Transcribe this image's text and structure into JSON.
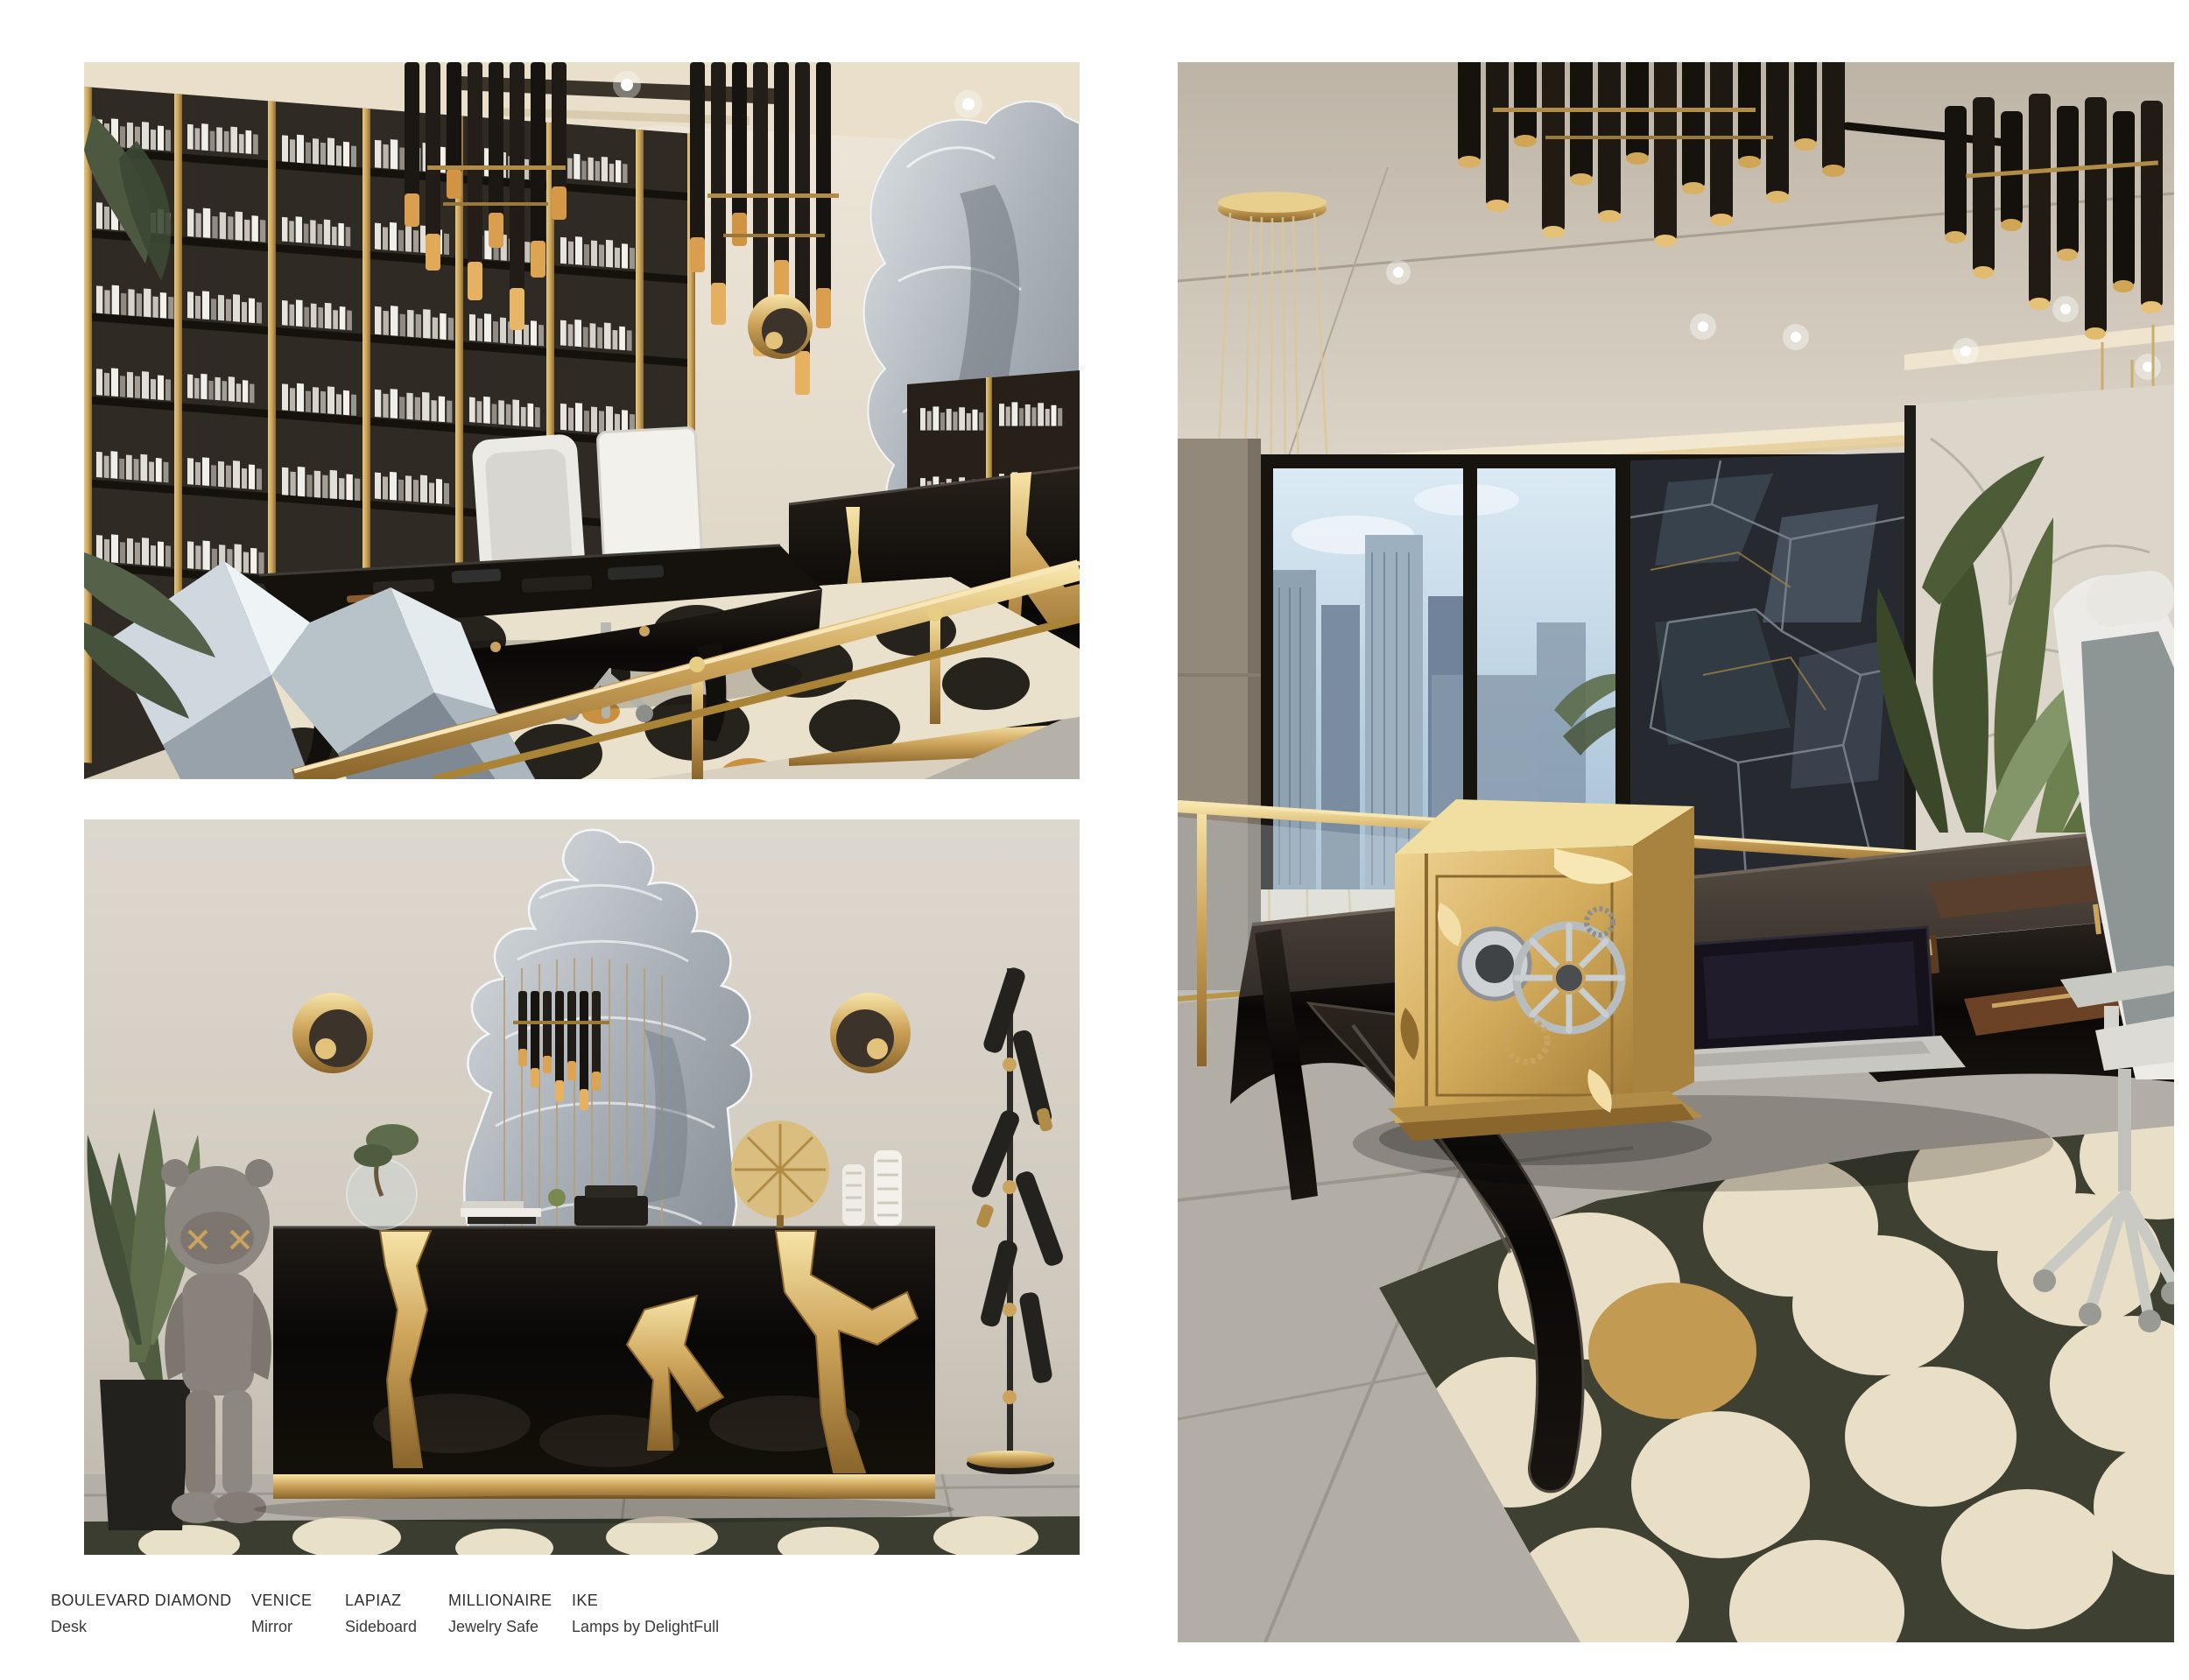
{
  "page": {
    "type": "furniture-catalog-page",
    "background": "#ffffff"
  },
  "captions": {
    "items": [
      {
        "name": "BOULEVARD DIAMOND",
        "type": "Desk"
      },
      {
        "name": "VENICE",
        "type": "Mirror"
      },
      {
        "name": "LAPIAZ",
        "type": "Sideboard"
      },
      {
        "name": "MILLIONAIRE",
        "type": "Jewelry Safe"
      },
      {
        "name": "IKE",
        "type": "Lamps by DelightFull"
      }
    ]
  },
  "photos": {
    "top_left": {
      "description": "Home office render: floor-to-ceiling bookshelf wall with gold trims, two black-and-amber tube chandeliers, glossy black desk with white chair and monitor, gold wall sconce, Venice mirror over a black console with torn gold detail, black-and-cream patterned rug, faceted mirror sculpture, gold stair railing in foreground"
    },
    "bottom_left": {
      "description": "Render of black Lapiaz sideboard with torn molten-gold cracks and gold plinth under an etched Venice mirror, flanked by two round gold sconces, grey KAWS figure covering its eyes and potted palm at left, black tube floor lamp at right, concrete floor with patterned rug strip"
    },
    "right": {
      "description": "Double-height office render: taupe ceiling with cove lighting and black-and-gold Ike tube chandeliers, glass wall with city skyline, angular smoked-mirror panels, marble wall with tall plant, gold Millionaire jewelry safe with silver dial and wheel standing on a glossy black curved-leg desk beside a laptop, white-framed task chair, dark olive rug with large cream circles and one gold circle"
    }
  },
  "colors": {
    "gold": "#c9a45f",
    "dark_gold": "#8f6b2e",
    "glossy_black": "#0d0b0a",
    "wall_cream": "#e8e2d6",
    "rug_cream": "#e9e0c8",
    "rug_olive": "#3f4233",
    "sky": "#c2d8e8",
    "caption_text": "#2e2e2e"
  }
}
